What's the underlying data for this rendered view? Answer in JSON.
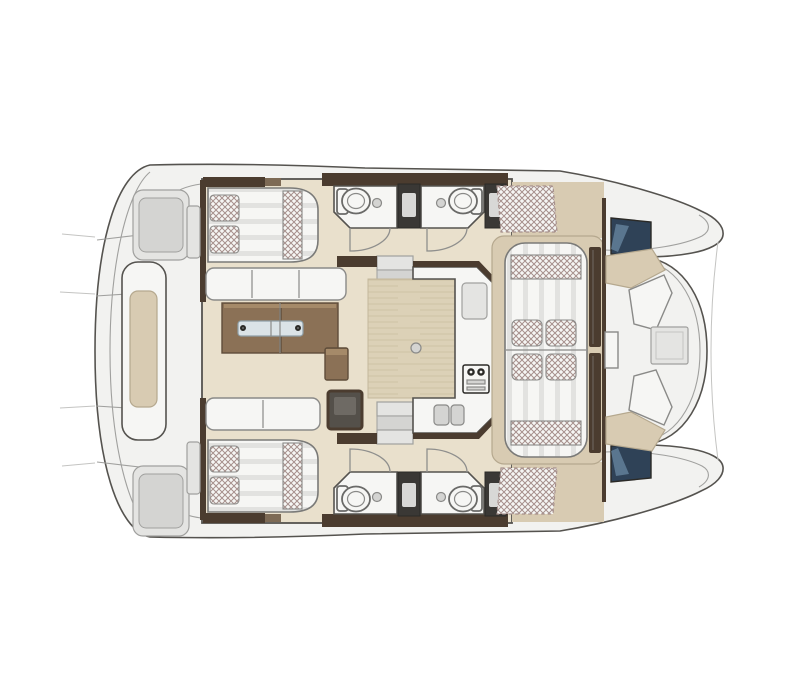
{
  "meta": {
    "title": "Catamaran interior layout — top-view floor plan",
    "type": "boat-floorplan",
    "text_on_image": "none"
  },
  "colors": {
    "bg": "#ffffff",
    "deck": "#f2f2f0",
    "deckline": "#a0a09e",
    "softline": "#c4c4c2",
    "outline": "#55534f",
    "darkline": "#2b2a27",
    "mid_line": "#8a8a88",
    "door_line": "#8f8f8d",
    "floor_tan": "#e9e0cc",
    "deck_tan": "#d8cbb2",
    "tan_dark": "#b5a88e",
    "wood": "#dcd1b7",
    "wood_line": "#c4b79b",
    "white_srf": "#f6f6f4",
    "grey_panel": "#e4e4e2",
    "grey_inner": "#d4d4d2",
    "brown_dark": "#4b3c2f",
    "brown_mid": "#7d6a55",
    "table_brown": "#8b7156",
    "table_top": "#a58a69",
    "table_dark": "#5f4d3a",
    "shower_dark": "#3a3835",
    "shower_panel": "#d8d8d6",
    "hatch_blue": "#2f4257",
    "hatch_hi": "#7292ad",
    "metal": "#dbe3e7",
    "metal_dark": "#8fa0a8",
    "hatch_line": "#a6908c",
    "stripe": "#e2e2e0",
    "bed_line": "#7a7a78",
    "toilet_line": "#6a6a68",
    "chart_dark": "#54504a",
    "chart_hi": "#6e6a64"
  },
  "features": {
    "double_berths": 2,
    "pillows_per_berth": 2,
    "head_compartments": 4,
    "toilets": 4,
    "shower_columns": 4,
    "companionway_stairs": 2,
    "dinette": {
      "benches": 2,
      "table_leaves": 2,
      "table_rail": "stainless"
    },
    "galley": {
      "shape": "U",
      "double_sink": 1,
      "cooktop": 1,
      "worktop_boxes": 1
    },
    "cockpit_lounge": {
      "sunpad_cushions": 4,
      "bolster_bands": 2
    },
    "forward_cockpit": {
      "bench_segments": 2,
      "backrests": 2,
      "table": 1,
      "deck_hatches": 2
    },
    "bow_platform": {
      "bench_cushion": 1,
      "deck_panels": 2
    }
  }
}
